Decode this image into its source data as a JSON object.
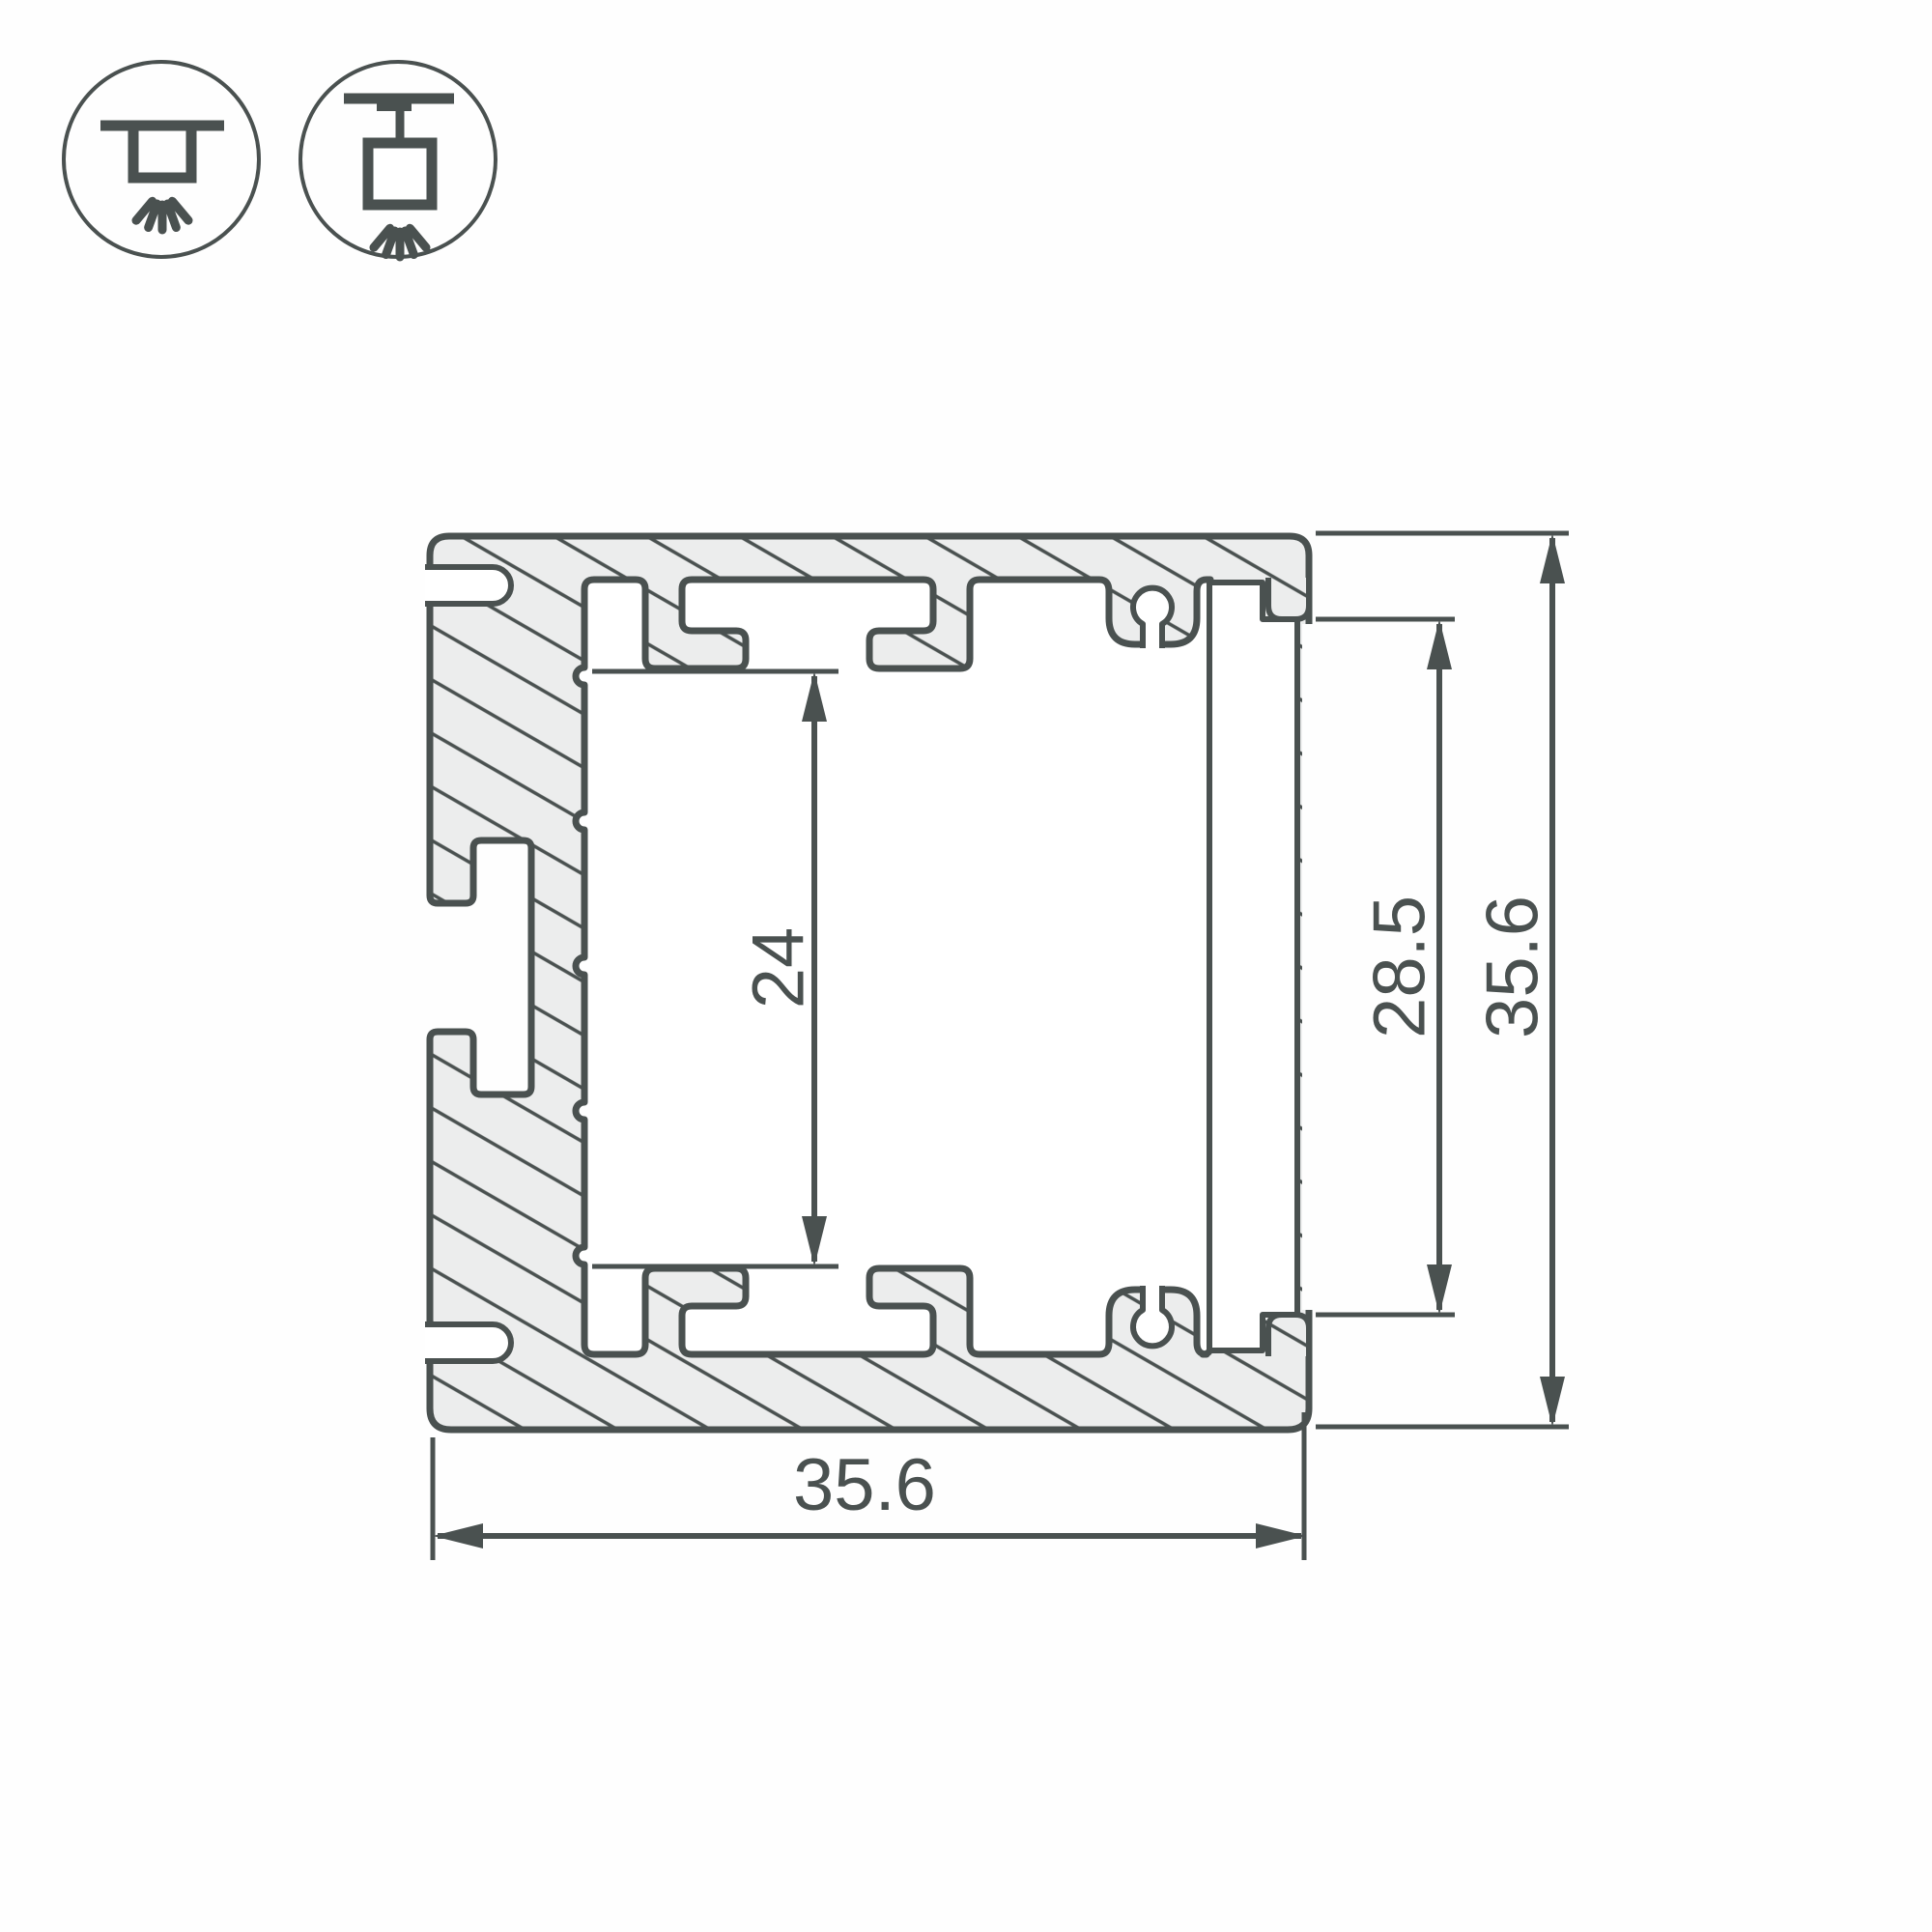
{
  "page": {
    "background": "#fefefe"
  },
  "drawing": {
    "type": "aluminium-led-profile-cross-section",
    "colors": {
      "outline": "#4a5150",
      "material_fill": "#eceded",
      "void_fill": "#ffffff",
      "dimension_color": "#4a5150"
    },
    "icons": [
      {
        "name": "surface-mount-icon"
      },
      {
        "name": "pendant-mount-icon"
      }
    ],
    "dimensions": {
      "inner_channel_height": {
        "label": "24"
      },
      "diffuser_opening_height": {
        "label": "28.5"
      },
      "overall_height": {
        "label": "35.6"
      },
      "overall_width": {
        "label": "35.6"
      }
    }
  }
}
